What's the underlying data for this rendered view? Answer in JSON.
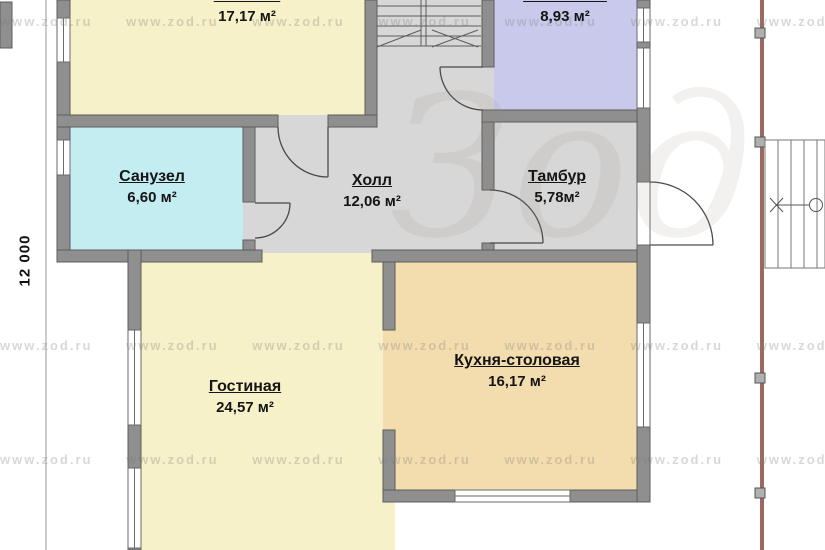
{
  "rooms": [
    {
      "name": "Комната",
      "area": "17,17 м²"
    },
    {
      "name": "Котельная",
      "area": "8,93 м²"
    },
    {
      "name": "Санузел",
      "area": "6,60 м²"
    },
    {
      "name": "Холл",
      "area": "12,06 м²"
    },
    {
      "name": "Тамбур",
      "area": "5,78м²"
    },
    {
      "name": "Гостиная",
      "area": "24,57 м²"
    },
    {
      "name": "Кухня-столовая",
      "area": "16,17 м²"
    }
  ],
  "dimension": {
    "left_vertical": "12 000"
  },
  "watermark": {
    "url_text": "www.zod.ru",
    "logo_text": "Зод"
  },
  "colors": {
    "room_fill_yellow": "#f7f1c9",
    "room_fill_tan": "#f3ddae",
    "room_fill_lavender": "#c9c9ec",
    "room_fill_cyan": "#c3edf1",
    "floor_gray": "#d7d7d7",
    "wall_gray": "#8f8f8f",
    "terrace_edge": "#9a6a5e"
  }
}
